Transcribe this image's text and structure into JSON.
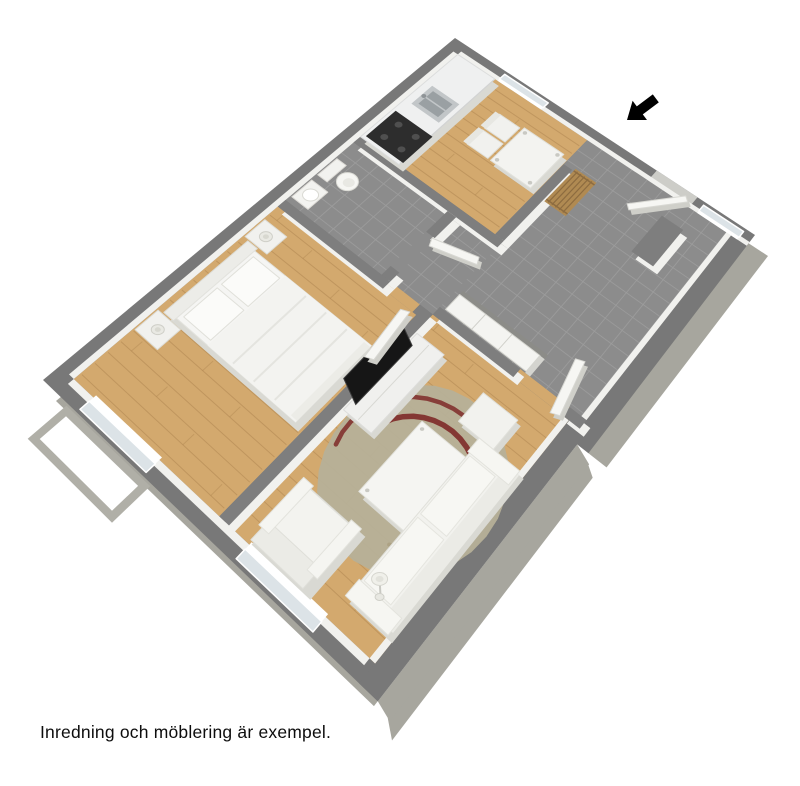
{
  "caption": {
    "text": "Inredning och möblering är exempel."
  },
  "scene": {
    "type": "3d-floor-plan",
    "description": "Isometric cutaway render of a one-bedroom apartment",
    "rooms": [
      {
        "name": "kitchen",
        "floor": "wood",
        "items": [
          "kitchen-counter",
          "sink",
          "stove",
          "dining-table",
          "dining-chairs"
        ]
      },
      {
        "name": "hallway",
        "floor": "gray-tile",
        "items": [
          "wardrobe",
          "coat-rack",
          "front-door-open",
          "entrance-vestibule"
        ]
      },
      {
        "name": "bathroom",
        "floor": "gray-tile",
        "items": [
          "toilet",
          "washbasin"
        ]
      },
      {
        "name": "bedroom",
        "floor": "wood",
        "items": [
          "double-bed",
          "pillows",
          "nightstand-left",
          "nightstand-right",
          "table-lamps",
          "window"
        ]
      },
      {
        "name": "living-room",
        "floor": "wood",
        "items": [
          "tv-stand",
          "tv",
          "sofa",
          "armchair",
          "ottoman",
          "coffee-table",
          "rug",
          "floor-lamp",
          "window"
        ]
      }
    ],
    "annotations": [
      {
        "name": "entrance-arrow",
        "label": "entrance direction indicator"
      }
    ]
  },
  "colors": {
    "wall_top": "#787878",
    "wall_top_inner": "#7e7e7e",
    "wall_outer_face": "#a7a69e",
    "inner_face": "#f1f1ee",
    "wood": "#d3a96e",
    "wood_line": "#a87f4b",
    "tile": "#8c8c8c",
    "tile_line": "#9d9d9d",
    "white_furniture": "#f2f2ef",
    "furniture_shadow": "#d9d9d3",
    "furniture_stroke": "#e0e0da",
    "tv_black": "#161616",
    "stove_black": "#2d2d2d",
    "steel": "#c2c6c8",
    "steel_dark": "#9aa0a3",
    "rug": "#b6b098",
    "rug_stripe": "#7a2222",
    "rug_stripe2": "#a59a78",
    "rack_wood": "#b08a52",
    "rack_line": "#8d6c40",
    "glass": "#dce3e7",
    "frame_white": "#ffffff",
    "door_white": "#f6f6f3",
    "threshold": "#cdcdc8",
    "balcony": "#b0afa7",
    "arrow_black": "#000000"
  }
}
